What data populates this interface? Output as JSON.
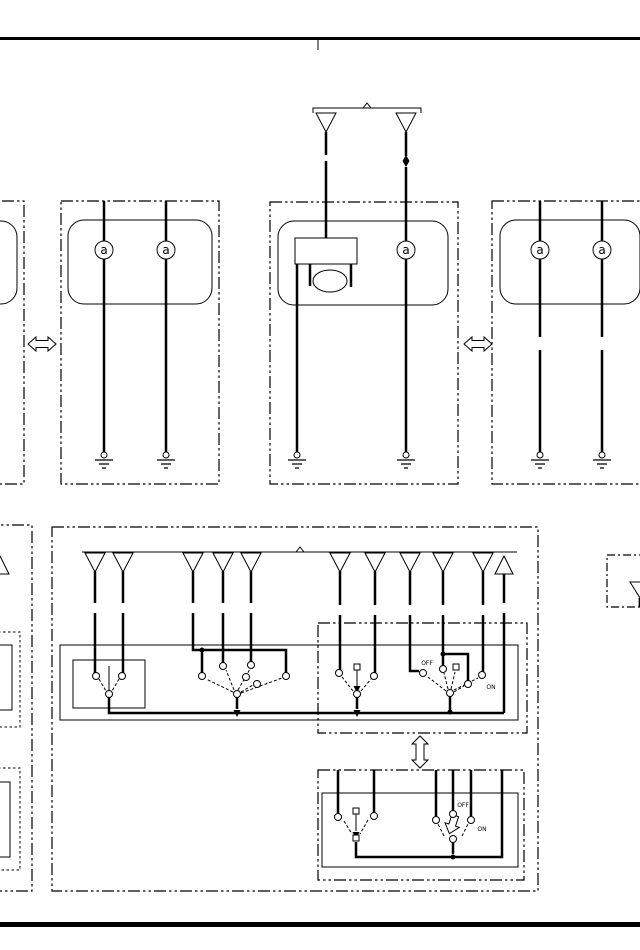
{
  "document": {
    "type": "automotive wiring diagram (overall electrical schematic section)",
    "ink_color": "#000000",
    "paper_color": "#ffffff"
  },
  "labels": {
    "lamp_letter": "a",
    "upper_switch_off": "OFF",
    "upper_switch_on": "ON",
    "lower_switch_off": "OFF",
    "lower_switch_on": "ON"
  },
  "symbols": {
    "bulbs": [
      [
        104,
        250
      ],
      [
        166,
        250
      ],
      [
        406,
        250
      ],
      [
        540,
        250
      ],
      [
        602,
        250
      ]
    ],
    "grounds": [
      [
        104,
        452
      ],
      [
        166,
        452
      ],
      [
        297,
        452
      ],
      [
        406,
        452
      ],
      [
        540,
        452
      ],
      [
        602,
        452
      ]
    ],
    "pins_down_top": [
      [
        326,
        113
      ],
      [
        406,
        113
      ]
    ],
    "pins_down_lower": [
      [
        95,
        553
      ],
      [
        123,
        553
      ],
      [
        193,
        553
      ],
      [
        223,
        553
      ],
      [
        251,
        553
      ],
      [
        340,
        553
      ],
      [
        375,
        553
      ],
      [
        410,
        553
      ],
      [
        443,
        553
      ],
      [
        483,
        553
      ]
    ],
    "pins_up": [
      [
        504,
        555
      ],
      [
        0,
        555
      ]
    ],
    "pins_down_partial": [
      [
        640,
        582
      ]
    ],
    "harness_arrows_horizontal": [
      [
        42,
        344
      ],
      [
        478,
        344
      ]
    ],
    "harness_arrows_vertical": [
      [
        420,
        752
      ]
    ],
    "contacts": [
      [
        96,
        676
      ],
      [
        122,
        676
      ],
      [
        109,
        694
      ],
      [
        202,
        676
      ],
      [
        223,
        666
      ],
      [
        251,
        665
      ],
      [
        246,
        677
      ],
      [
        257,
        684
      ],
      [
        286,
        676
      ],
      [
        237,
        694
      ],
      [
        339,
        673
      ],
      [
        374,
        676
      ],
      [
        357,
        694
      ],
      [
        423,
        673
      ],
      [
        443,
        669
      ],
      [
        468,
        684
      ],
      [
        482,
        675
      ],
      [
        450,
        693
      ],
      [
        338,
        817
      ],
      [
        374,
        816
      ],
      [
        436,
        820
      ],
      [
        453,
        814
      ],
      [
        471,
        820
      ],
      [
        453,
        839
      ]
    ],
    "contact_squares": [
      [
        357,
        667
      ],
      [
        456,
        667
      ],
      [
        356,
        811
      ],
      [
        356,
        838
      ]
    ],
    "junction_dots": [
      [
        202,
        650
      ],
      [
        443,
        654
      ],
      [
        450,
        712
      ],
      [
        453,
        857
      ]
    ],
    "junction_arrowheads": [
      [
        237,
        712
      ],
      [
        357,
        712
      ],
      [
        357,
        688
      ],
      [
        356,
        834
      ]
    ],
    "splice_diamonds": [
      [
        406,
        161
      ]
    ]
  }
}
